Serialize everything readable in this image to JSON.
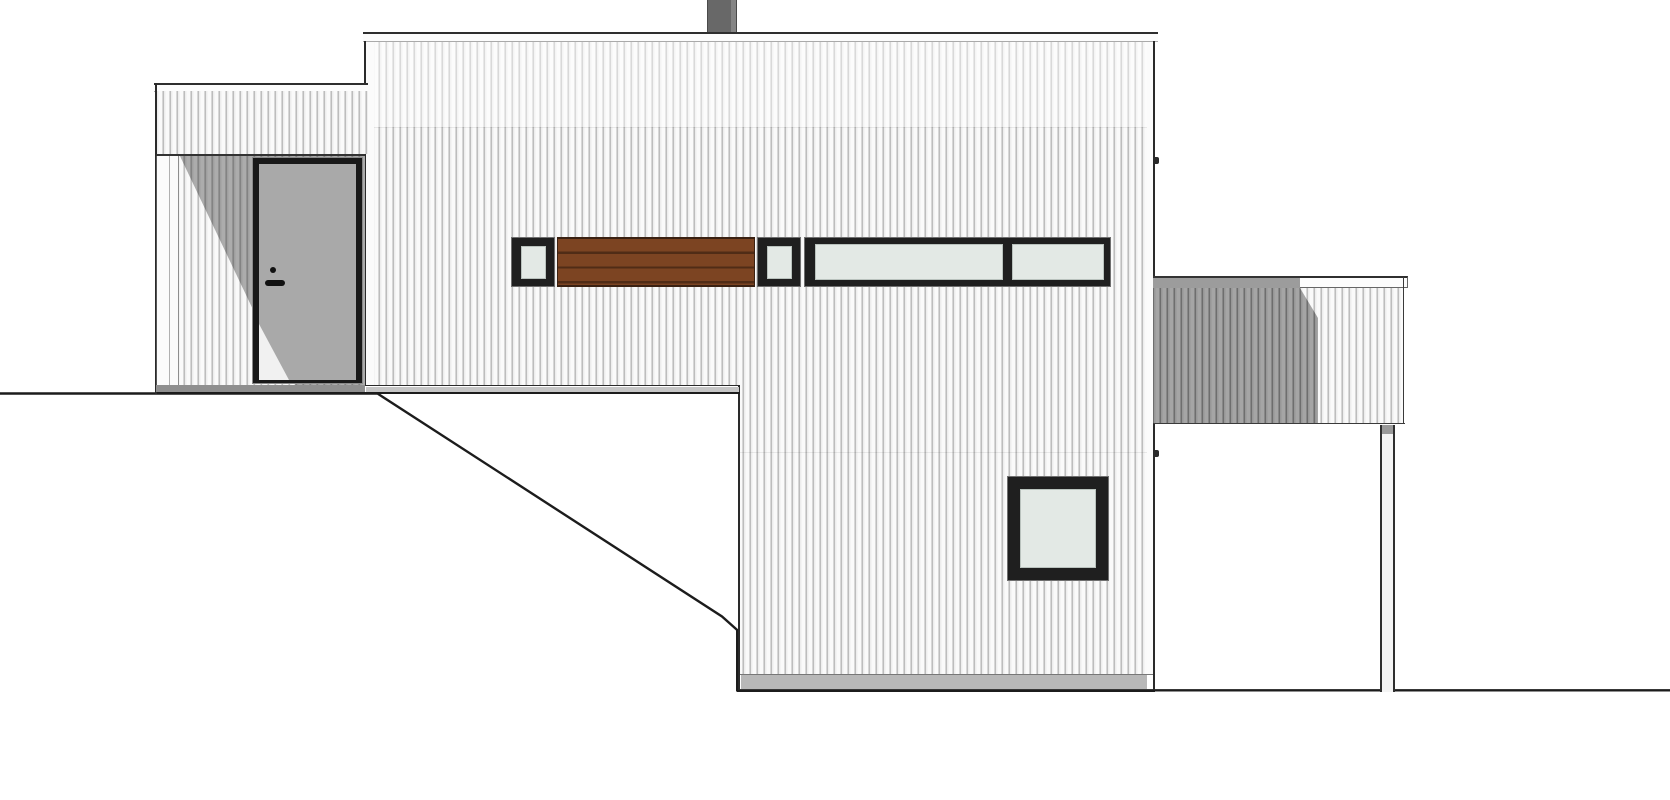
{
  "scene": {
    "kind": "architectural-elevation-drawing",
    "elements": [
      "chimney",
      "main-volume",
      "entry-wing",
      "entry-door",
      "window-band",
      "wood-slat-panel",
      "square-window",
      "terrace",
      "terrace-post",
      "ground-line"
    ]
  },
  "palette": {
    "background": "#ffffff",
    "ground": "#1c1c1c",
    "fascia": "#fcfcfc",
    "corner_board": "#fbfbfb",
    "chimney": "#686868",
    "chimney_light": "#858585",
    "door_frame": "#191919",
    "door_leaf": "#a9a9a9",
    "door_leaf_lit": "#f1f1f1",
    "hardware": "#111111",
    "glass": "#e3e9e5",
    "window_frame": "#1f1f1f",
    "window_outer_line": "#6f6f6f",
    "wood": "#7c4422",
    "wood_line": "#502c16",
    "wood_edge": "#3a2112",
    "porch_floor": "#8f8f8f",
    "base_strip": "#c6c6c6",
    "base_strip_lower": "#b8b8b8",
    "terrace_fascia_dark": "#9c9c9c",
    "post_fill": "#f4f4f4",
    "post_cap": "#9a9a9a"
  }
}
